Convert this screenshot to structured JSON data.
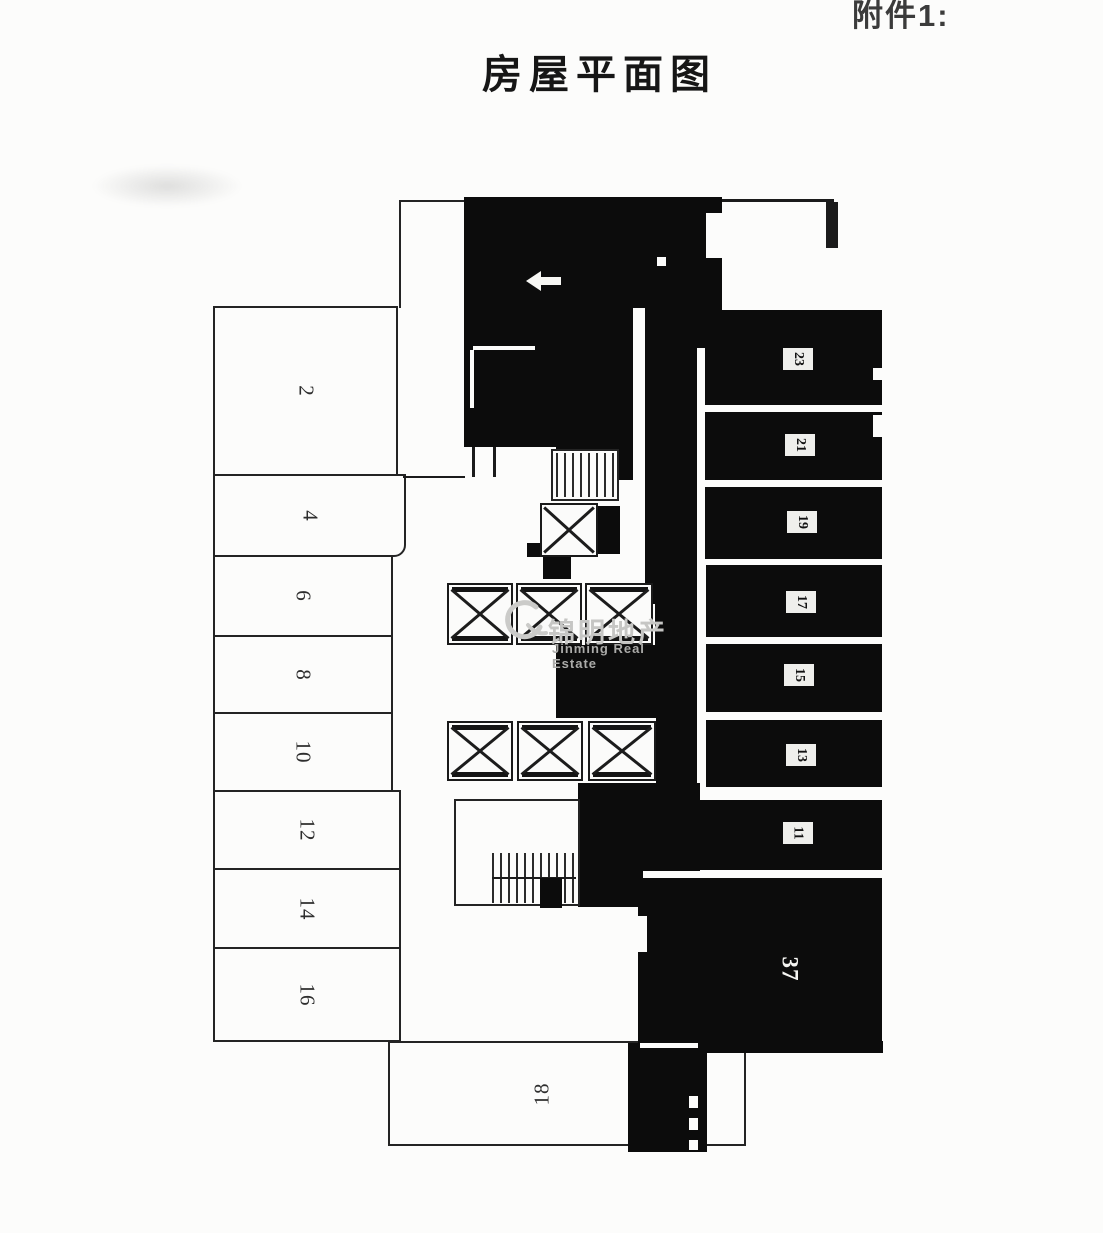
{
  "header": {
    "attachment_label": "附件1:",
    "title": "房屋平面图"
  },
  "watermark": {
    "name_cn": "锦明地产",
    "name_en": "Jinming Real Estate"
  },
  "rooms": {
    "left": [
      "2",
      "4",
      "6",
      "8",
      "10",
      "12",
      "14",
      "16"
    ],
    "bottom": "18",
    "right": [
      "23",
      "21",
      "19",
      "17",
      "15",
      "13",
      "11"
    ],
    "large": "37"
  },
  "colors": {
    "ink": "#242424",
    "fill_black": "#0c0c0c",
    "paper": "#fcfcfb",
    "watermark_gray": "#c6c6c4"
  }
}
